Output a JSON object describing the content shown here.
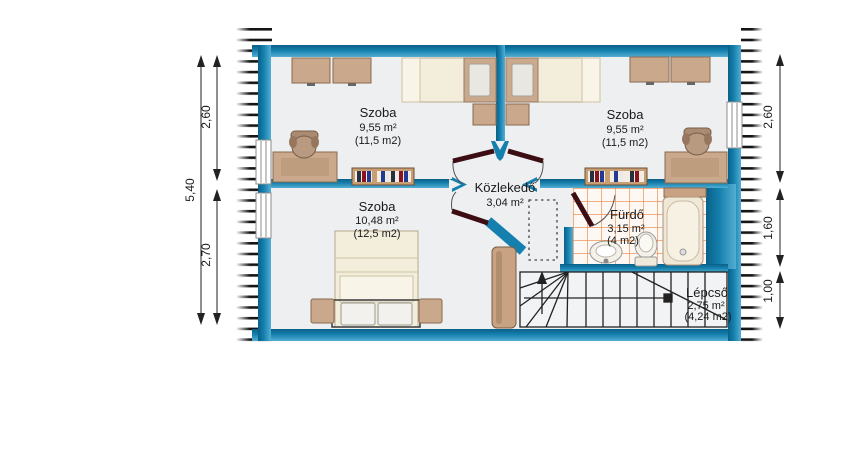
{
  "title": "Floor plan - attic level",
  "rooms": {
    "szoba_top_left": {
      "name": "Szoba",
      "area": "9,55 m²",
      "area_alt": "(11,5 m2)"
    },
    "szoba_top_right": {
      "name": "Szoba",
      "area": "9,55 m²",
      "area_alt": "(11,5 m2)"
    },
    "szoba_bottom": {
      "name": "Szoba",
      "area": "10,48 m²",
      "area_alt": "(12,5 m2)"
    },
    "kozlekedo": {
      "name": "Közlekedő",
      "area": "3,04 m²"
    },
    "furdo": {
      "name": "Fürdő",
      "area": "3,15 m²",
      "area_alt": "(4 m2)"
    },
    "lepcso": {
      "name": "Lépcső",
      "area": "2,75 m²",
      "area_alt": "(4,24 m2)"
    }
  },
  "dimensions": {
    "left_total": "5,40",
    "left_top": "2,60",
    "left_bottom": "2,70",
    "right_top": "2,60",
    "right_middle": "1,60",
    "right_bottom": "1,00"
  },
  "colors": {
    "wall": "#1580ae",
    "wall_dark": "#0a6088",
    "wall_light": "#54aed2",
    "floor": "#edeff0",
    "furniture": "#c9a88c",
    "furniture_dark": "#8a6a50",
    "bed": "#f3eedb",
    "door_leaf": "#3c0e13",
    "tile_grid": "#e8813e",
    "stair_line": "#222222"
  }
}
